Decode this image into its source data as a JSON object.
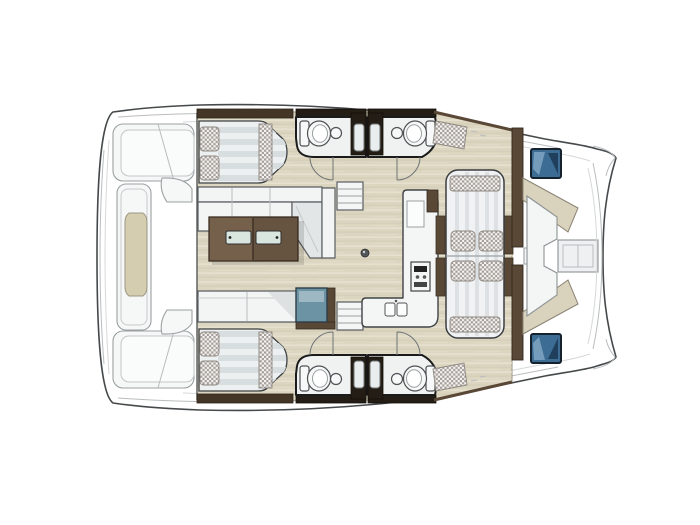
{
  "diagram": {
    "kind": "boat-floorplan",
    "subject": "sailing catamaran interior and deck layout, top-down view",
    "bow_direction": "right",
    "hulls": 2
  },
  "palette": {
    "background": "#ffffff",
    "hull": "#f8f9f9",
    "hull_outline": "#46494b",
    "wood_floor": "#dcd6c1",
    "wood_floor_light": "#e9e3d2",
    "wood_floor_dark": "#cfc8b0",
    "tan_inset": "#d5cdb0",
    "table_wood": "#75604b",
    "headboard_wood": "#443627",
    "bulkhead_wood": "#5a4836",
    "dark_wall": "#241d15",
    "upholstery_dot": "#a59d98",
    "hatch_blue": "#3c6c94",
    "hatch_blue_light": "#7fa6c2",
    "cooler_blue": "#6b93a4",
    "glass_insert": "#d8e6df",
    "fwd_pad_beige": "#d9d2bc"
  },
  "inventory": {
    "stern_platform": {
      "transom_step_units": 2,
      "center_block_with_inset": 1
    },
    "aft_cabins": [
      {
        "id": "port-aft-cabin",
        "bed_pillows": 2,
        "bed_checkered_bands": 1
      },
      {
        "id": "starboard-aft-cabin",
        "bed_pillows": 2,
        "bed_checkered_bands": 1
      }
    ],
    "salon": {
      "sofa": "L-shaped",
      "coffee_table_glass_inserts": 2,
      "aft_bench_sections": 2,
      "cooler_units": 1
    },
    "bathrooms": [
      {
        "id": "port-forward-head",
        "fixtures": [
          "toilet",
          "washbasin",
          "shower"
        ]
      },
      {
        "id": "port-aft-head",
        "fixtures": [
          "toilet",
          "washbasin",
          "shower"
        ]
      },
      {
        "id": "starboard-forward-head",
        "fixtures": [
          "toilet",
          "washbasin",
          "shower"
        ]
      },
      {
        "id": "starboard-aft-head",
        "fixtures": [
          "toilet",
          "washbasin",
          "shower"
        ]
      }
    ],
    "galley": {
      "sink_basins": 2,
      "stove_units": 1,
      "cabinets": 1
    },
    "companionway_steps_units": 2,
    "dinette_lounge": {
      "cushions": 4,
      "checkered_bands": 2,
      "wood_rails": 4
    },
    "forward_cockpit": {
      "deck_hatches": 2,
      "center_table": 1,
      "beige_pads": 2
    },
    "deck": {
      "checkered_step_pads": 2,
      "door_swing_arcs": 4
    }
  }
}
